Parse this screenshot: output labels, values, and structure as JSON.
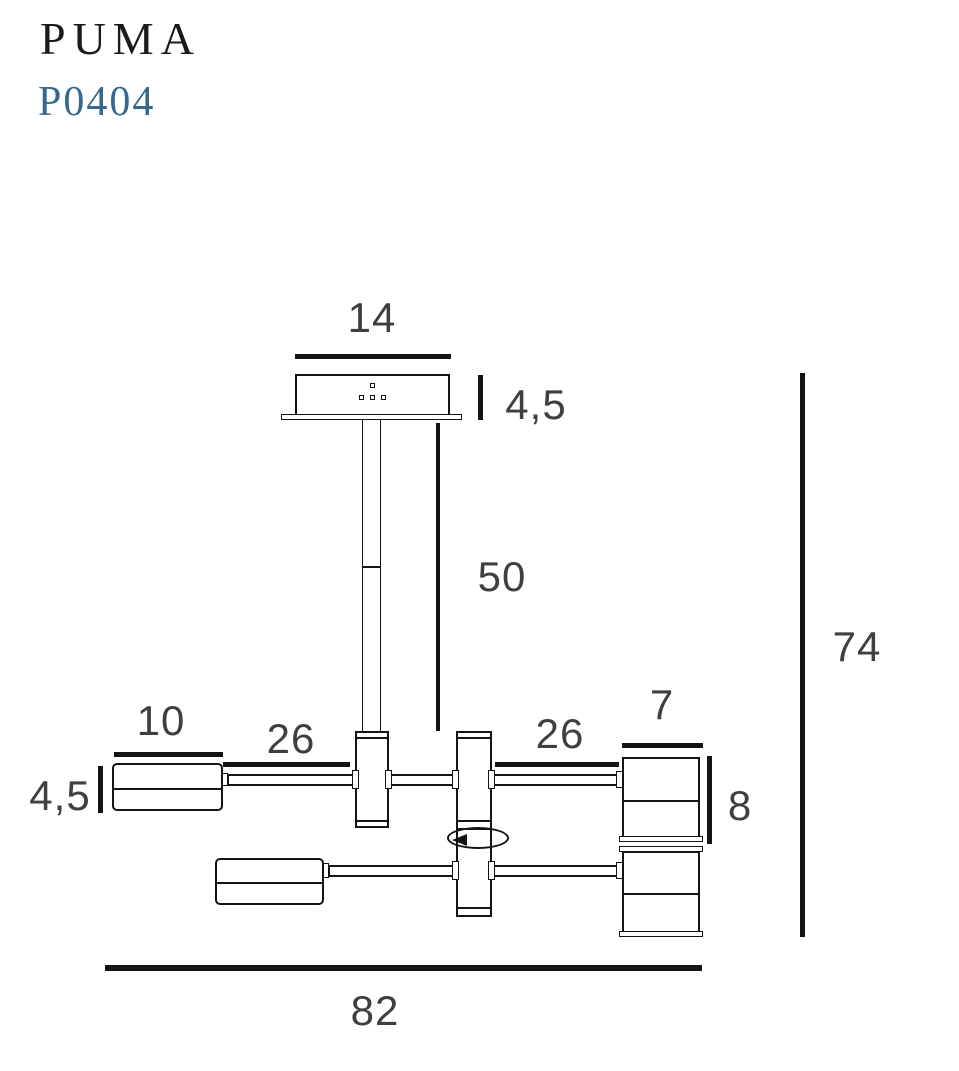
{
  "header": {
    "product_name": "PUMA",
    "product_code": "P0404"
  },
  "colors": {
    "line": "#141414",
    "dim-text": "#3f3f3f",
    "accent": "#36688f",
    "title": "#1b1b1b",
    "bg": "#ffffff"
  },
  "dimensions": {
    "canopy_width": "14",
    "canopy_depth": "4,5",
    "rod_length": "50",
    "overall_height": "74",
    "left_shade_length": "10",
    "left_shade_diameter": "4,5",
    "left_arm_span": "26",
    "right_arm_span": "26",
    "right_shade_diameter": "7",
    "right_shade_height": "8",
    "overall_width": "82"
  }
}
